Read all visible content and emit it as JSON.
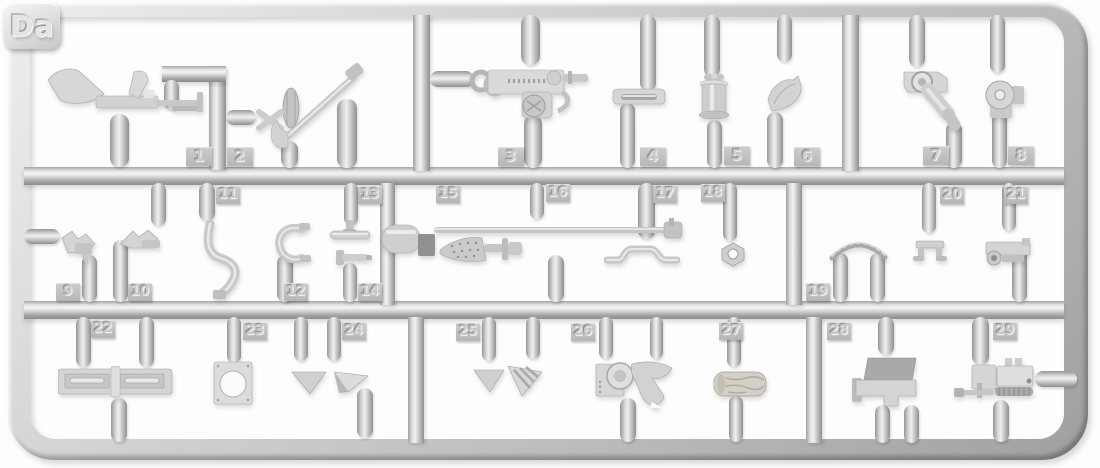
{
  "sprue": {
    "label": "Da",
    "plastic_color": "#c9c9c9",
    "background_color": "#fdfdfd",
    "parts": [
      {
        "number": "1",
        "name": "light-machine-gun"
      },
      {
        "number": "2",
        "name": "aa-gun-mount-with-barrel"
      },
      {
        "number": "3",
        "name": "heavy-machine-gun-receiver"
      },
      {
        "number": "4",
        "name": "mounting-bracket-plate"
      },
      {
        "number": "5",
        "name": "small-drum-canister"
      },
      {
        "number": "6",
        "name": "curved-bracket"
      },
      {
        "number": "7",
        "name": "swing-arm-mount"
      },
      {
        "number": "8",
        "name": "round-knob-mount"
      },
      {
        "number": "9",
        "name": "clamp-bracket"
      },
      {
        "number": "10",
        "name": "fork-bracket"
      },
      {
        "number": "11",
        "name": "curved-hose"
      },
      {
        "number": "12",
        "name": "c-shaped-hook"
      },
      {
        "number": "13",
        "name": "t-handle"
      },
      {
        "number": "14",
        "name": "t-pin"
      },
      {
        "number": "15",
        "name": "barrel-rod-with-block"
      },
      {
        "number": "16",
        "name": "finned-cone-adapter"
      },
      {
        "number": "17",
        "name": "tow-bar"
      },
      {
        "number": "18",
        "name": "hex-nut-washer"
      },
      {
        "number": "19",
        "name": "chain-links"
      },
      {
        "number": "20",
        "name": "u-shaped-clamp"
      },
      {
        "number": "21",
        "name": "periscope-box"
      },
      {
        "number": "22",
        "name": "louvered-vent-plate"
      },
      {
        "number": "23",
        "name": "square-plate-with-hole"
      },
      {
        "number": "24",
        "name": "triangular-gussets"
      },
      {
        "number": "25",
        "name": "triangular-gussets"
      },
      {
        "number": "26",
        "name": "gun-shield"
      },
      {
        "number": "27",
        "name": "wooden-log"
      },
      {
        "number": "28",
        "name": "stepped-bracket-assembly"
      },
      {
        "number": "29",
        "name": "machine-gun-with-mount"
      }
    ]
  }
}
